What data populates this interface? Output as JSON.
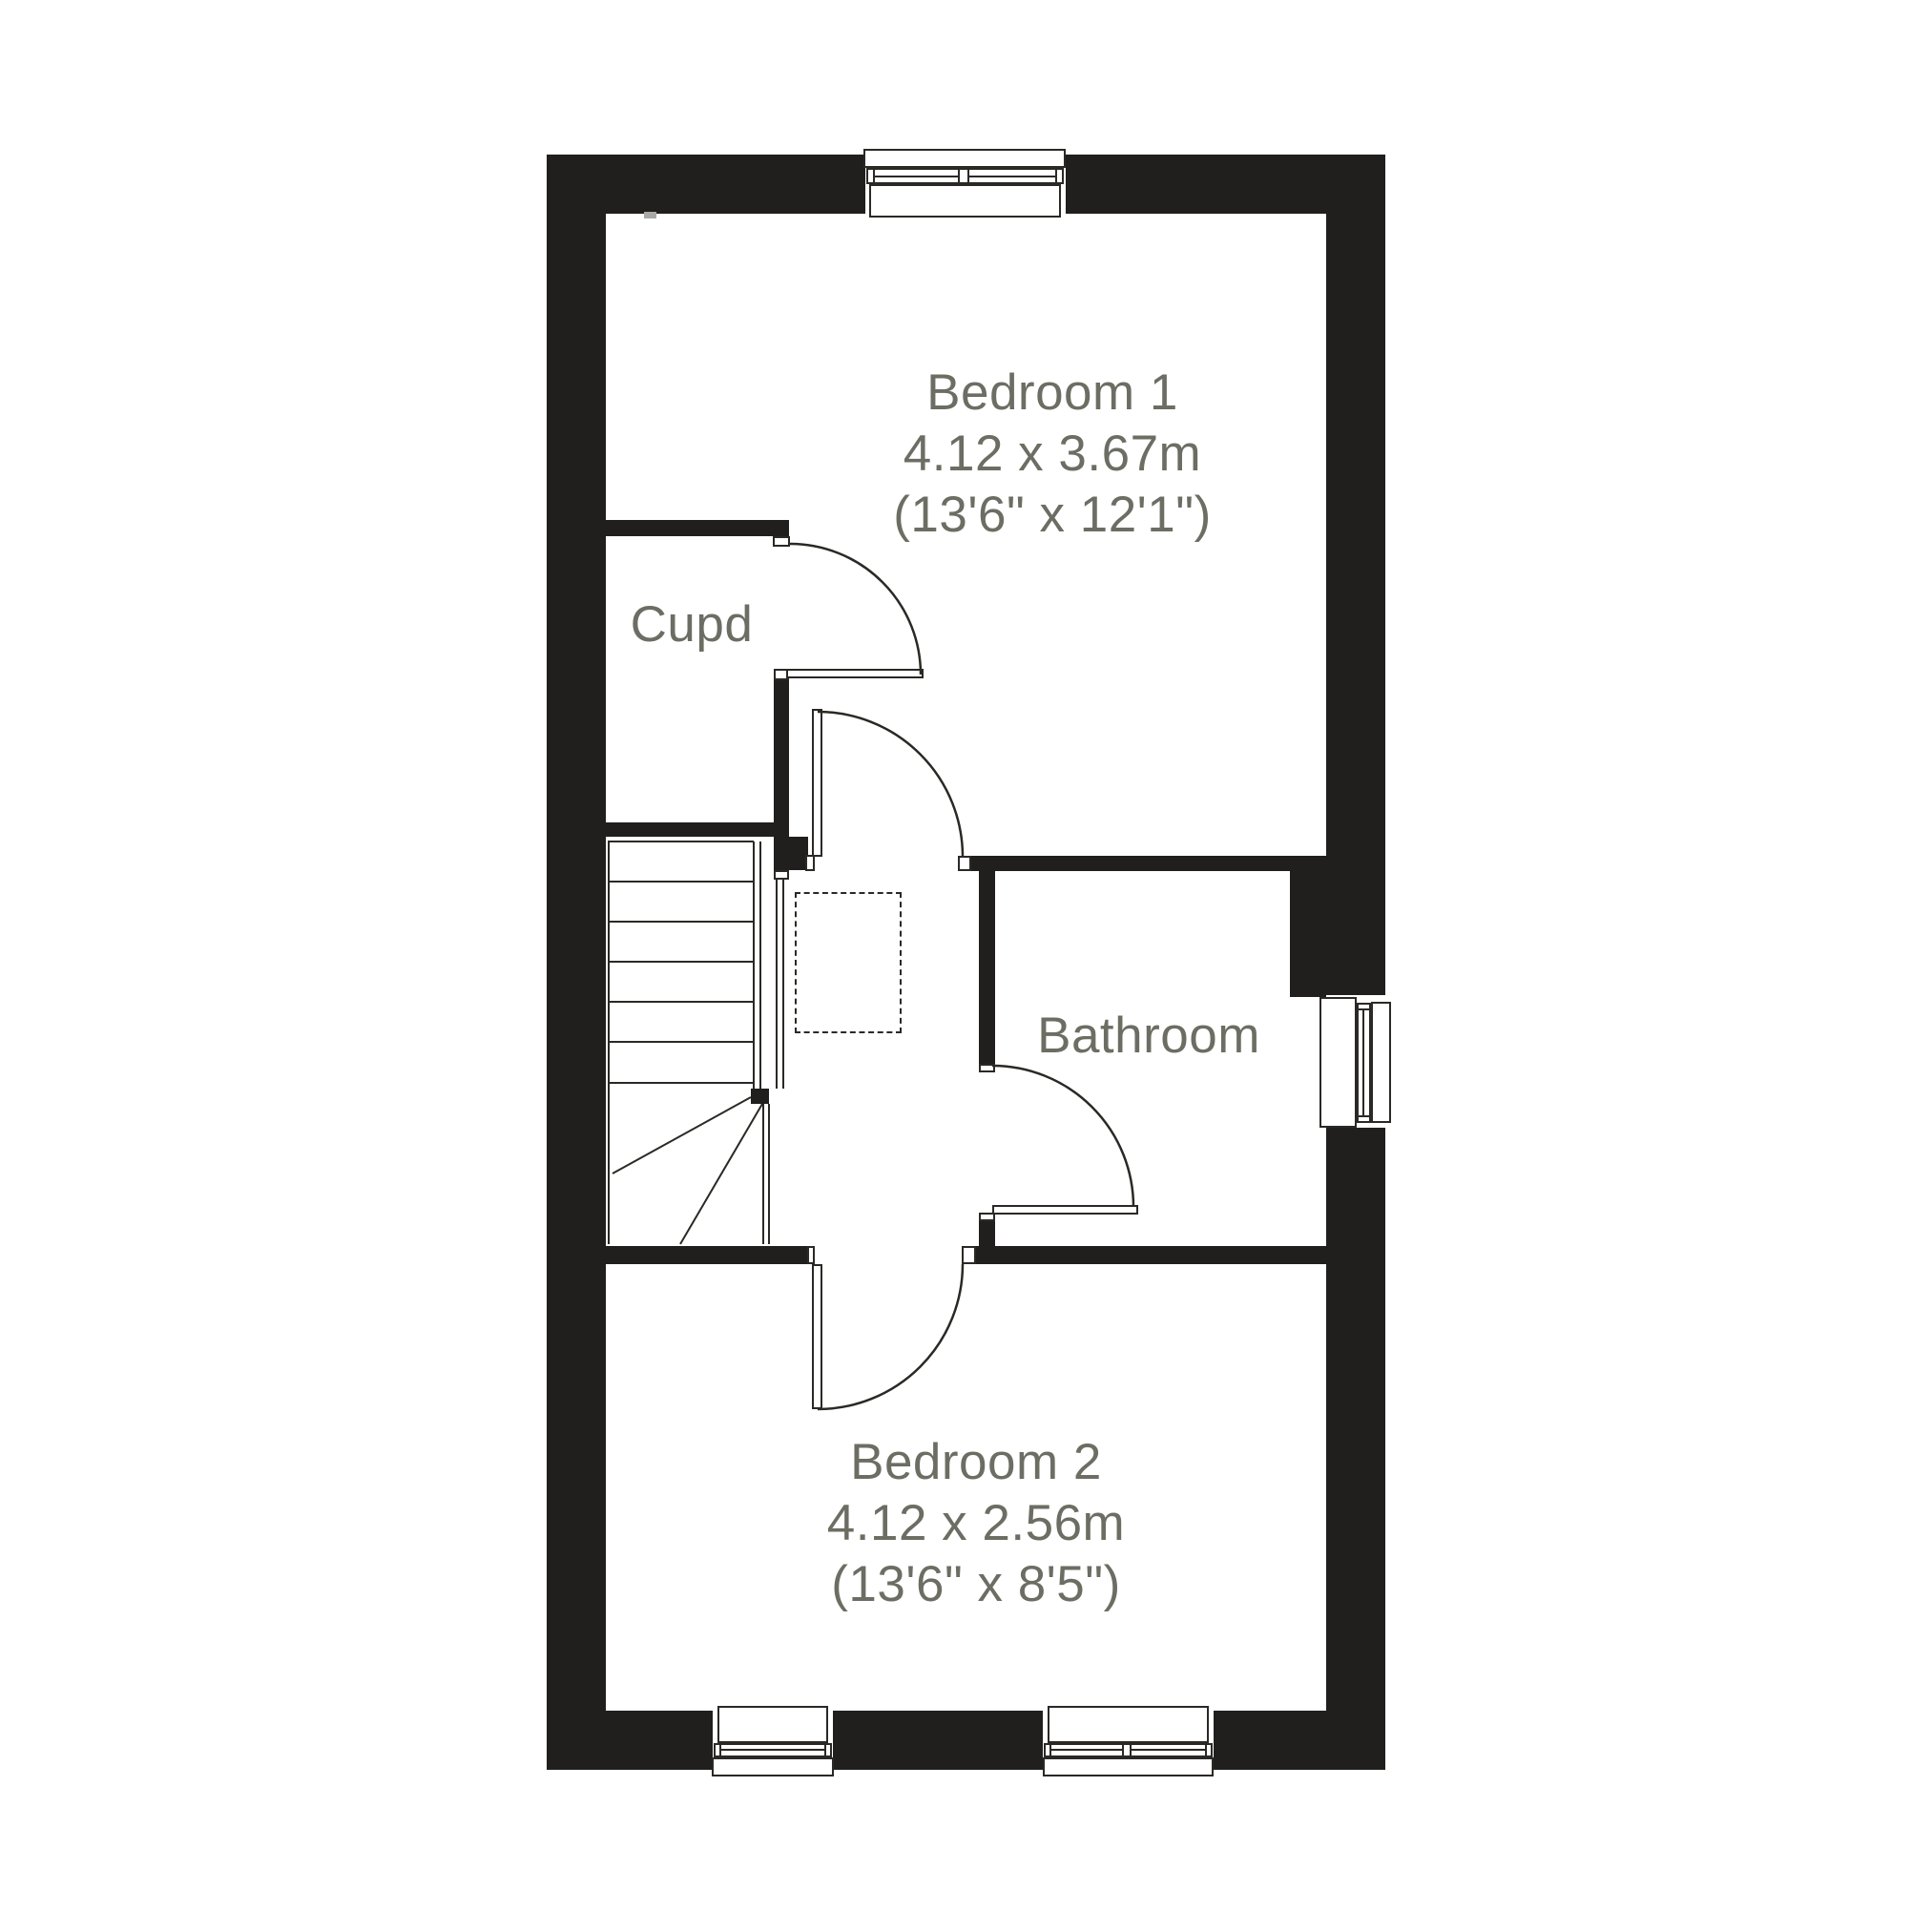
{
  "meta": {
    "type": "floor-plan"
  },
  "colors": {
    "wall": "#211f1d",
    "line": "#2b2925",
    "label": "#6c6d63",
    "background": "#ffffff",
    "marker": "#a9a9a5"
  },
  "rooms": [
    {
      "id": "bedroom-1",
      "label": "Bedroom 1",
      "size_metric": "4.12 x 3.67m",
      "size_imperial": "(13'6\" x 12'1\")"
    },
    {
      "id": "cupboard",
      "label": "Cupd"
    },
    {
      "id": "bathroom",
      "label": "Bathroom"
    },
    {
      "id": "bedroom-2",
      "label": "Bedroom 2",
      "size_metric": "4.12 x 2.56m",
      "size_imperial": "(13'6\" x 8'5\")"
    }
  ]
}
